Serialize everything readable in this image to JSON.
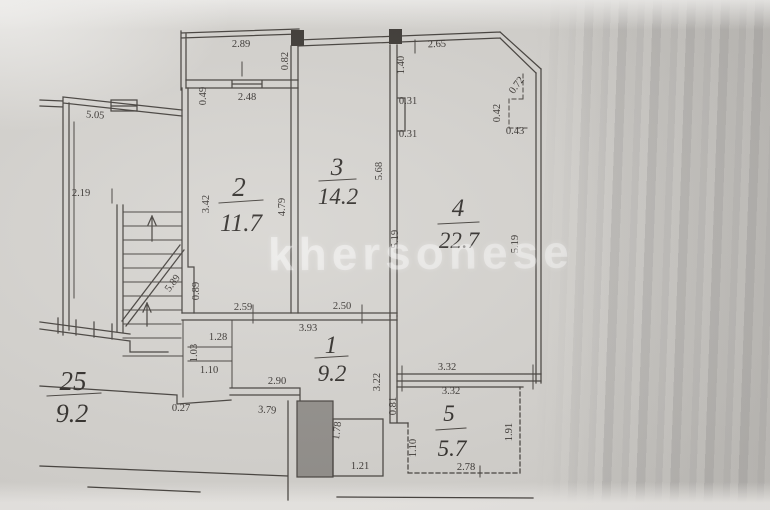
{
  "watermark": "khersonese",
  "rooms": {
    "room1": {
      "number": "1",
      "area": "9.2"
    },
    "room2": {
      "number": "2",
      "area": "11.7"
    },
    "room3": {
      "number": "3",
      "area": "14.2"
    },
    "room4": {
      "number": "4",
      "area": "22.7"
    },
    "room5": {
      "number": "5",
      "area": "5.7"
    },
    "adjacent_partial": {
      "number": "25",
      "area": "9.2"
    }
  },
  "dims": {
    "balcony_width": "2.89",
    "balcony_depth": "0.82",
    "room2_top_width": "2.48",
    "wall_seg": "0.49",
    "left_apt_top": "5.05",
    "left_apt_width": "2.19",
    "room2_height": "3.42",
    "room23_wall": "4.79",
    "room2_bottom": "2.59",
    "room2_left_seg": "0.89",
    "room3_height": "5.68",
    "room3_bottom": "2.50",
    "room3_top_seg": "1.40",
    "pilaster_a": "0.31",
    "pilaster_b": "0.31",
    "room4_top": "2.65",
    "chamfer": "0.72",
    "step_v": "0.42",
    "step_h": "0.43",
    "room4_left": "5.19",
    "room4_right": "5.19",
    "room4_bottom": "3.32",
    "room5_top": "3.32",
    "stairs_run": "5.89",
    "hall_top": "3.93",
    "closet_a": "1.28",
    "closet_b": "1.03",
    "closet_c": "1.10",
    "hall_bottom_a": "2.90",
    "hall_step": "0.27",
    "hall_bottom_b": "3.79",
    "hall_right": "3.22",
    "room5_left_seg": "0.81",
    "room5_right": "1.91",
    "room5_left": "1.10",
    "room5_bottom": "2.78",
    "shaft_h": "1.78",
    "shaft_w": "1.21"
  }
}
